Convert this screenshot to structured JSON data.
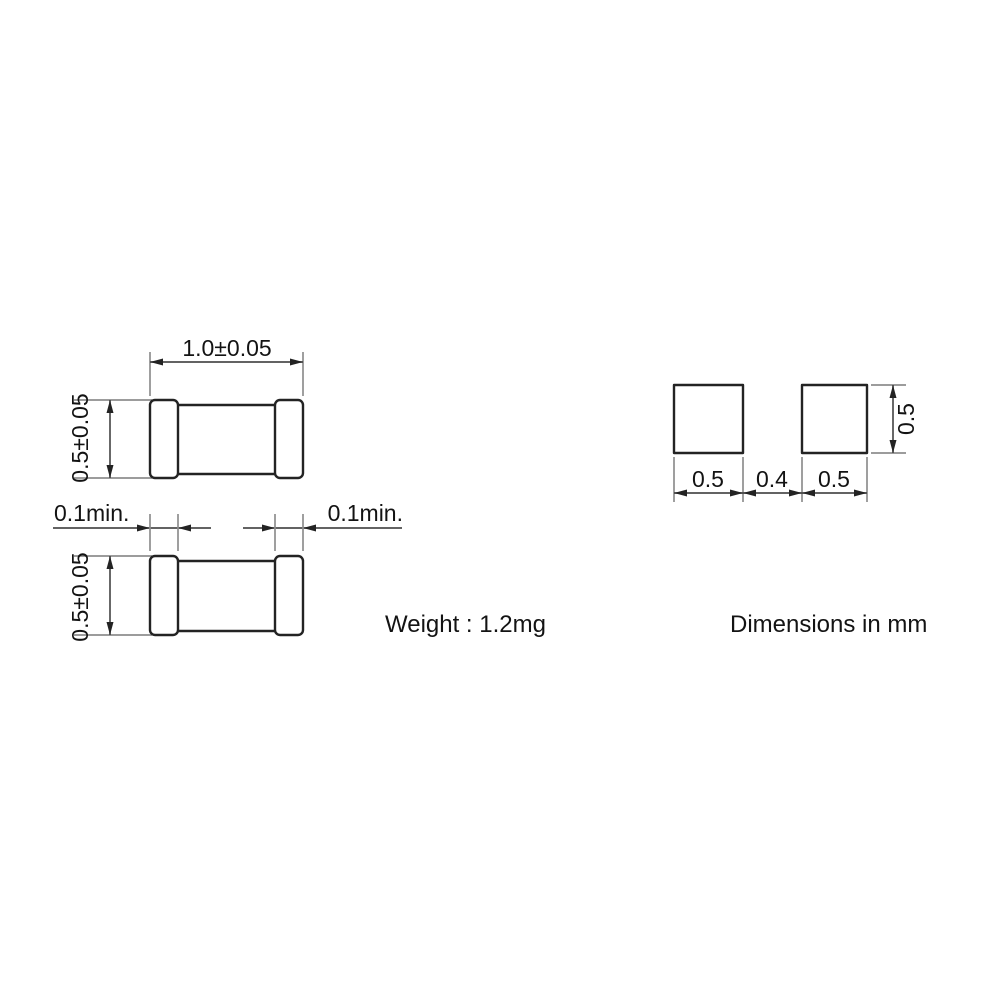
{
  "drawing": {
    "top_view": {
      "length": "1.0±0.05",
      "height": "0.5±0.05"
    },
    "side_view": {
      "height": "0.5±0.05",
      "left_margin": "0.1min.",
      "right_margin": "0.1min."
    },
    "land_pattern": {
      "left_pad_width": "0.5",
      "gap_width": "0.4",
      "right_pad_width": "0.5",
      "pad_height": "0.5"
    },
    "notes": {
      "weight": "Weight : 1.2mg",
      "units": "Dimensions in mm"
    },
    "colors": {
      "background": "#ffffff",
      "outline": "#232323",
      "dimension_line": "#4d4d4d",
      "extension_line": "#8e8e8e",
      "text": "#131313"
    }
  }
}
